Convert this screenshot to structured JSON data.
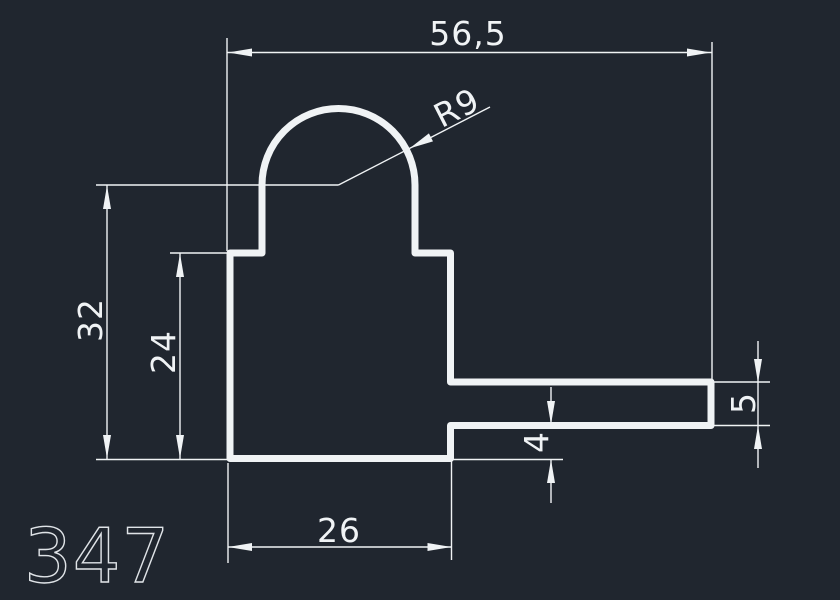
{
  "drawing": {
    "part_number": "347",
    "dimensions": {
      "top_width": "56,5",
      "radius": "R9",
      "overall_height": "32",
      "upper_body_height": "24",
      "bottom_width": "26",
      "notch_height": "4",
      "arm_thickness": "5"
    }
  },
  "colors": {
    "background": "#20262f",
    "line": "#f0f3f5",
    "part_number": "#dfe3e7"
  }
}
